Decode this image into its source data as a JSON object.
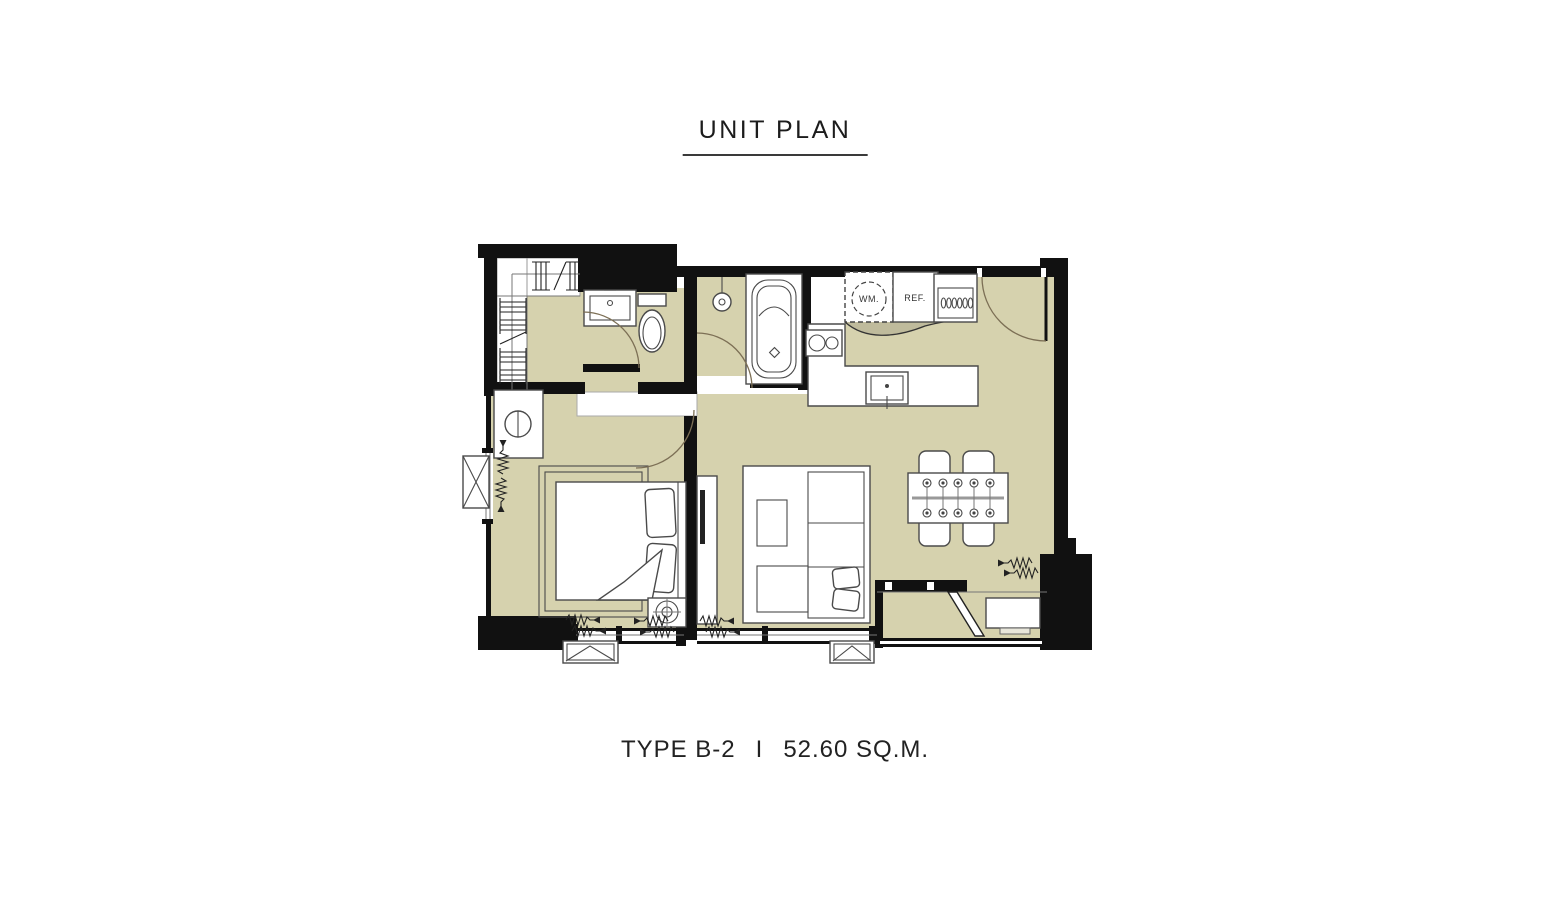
{
  "title": "UNIT PLAN",
  "footer": {
    "type_label": "TYPE B-2",
    "divider": "I",
    "area_label": "52.60 SQ.M."
  },
  "plan": {
    "appliances": {
      "washing_machine_label": "WM.",
      "refrigerator_label": "REF."
    },
    "colors": {
      "floor_beige": "#d6d2ae",
      "wall_black": "#111111",
      "furniture_line": "#4a4a4a",
      "door_arc": "#7c6f55",
      "background": "#ffffff"
    }
  }
}
